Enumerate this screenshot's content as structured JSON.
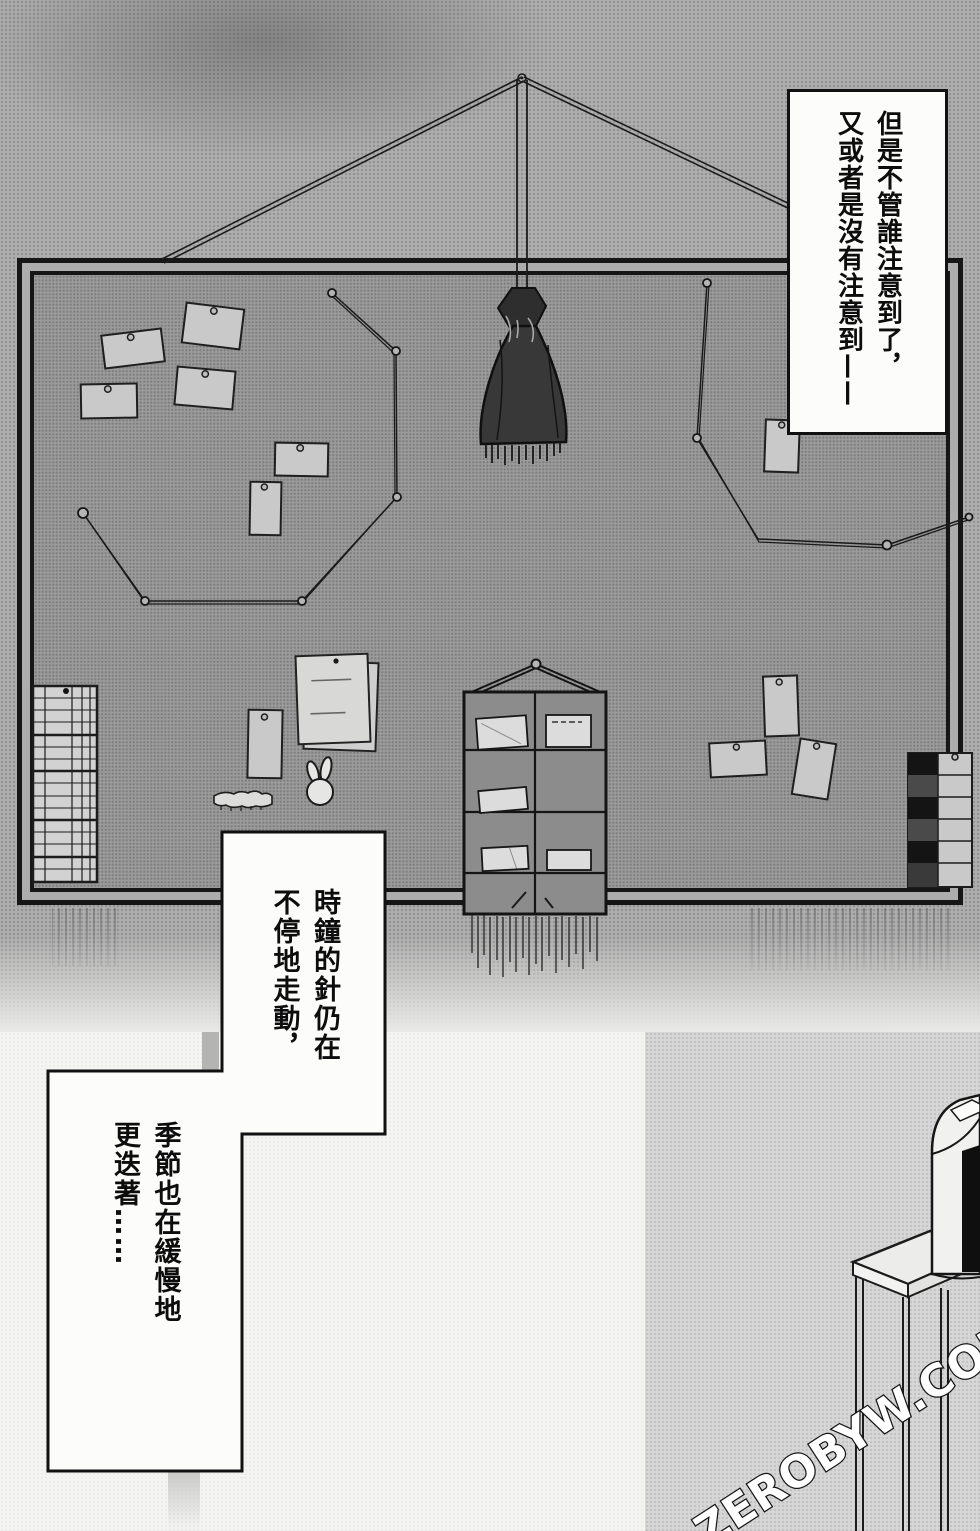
{
  "watermark": {
    "text": "ZEROBYW.COM"
  },
  "balloons": {
    "narration": {
      "line1": "但是不管誰注意到了，",
      "line2": "又或者是沒有注意到——"
    },
    "caption_clock": {
      "line1": "時鐘的針仍在",
      "line2": "不停地走動，"
    },
    "caption_seasons": {
      "line1": "季節也在緩慢地",
      "line2": "更迭著……"
    }
  },
  "colors": {
    "ink": "#161616",
    "wall": "#adadad",
    "board_surface": "#9b9b9b",
    "balloon_bg": "#fcfcfa",
    "card": "#c9c9c9",
    "organizer": "#8c8c8c",
    "bag": "#383838",
    "bottom_panel": "#d6d6d6"
  }
}
